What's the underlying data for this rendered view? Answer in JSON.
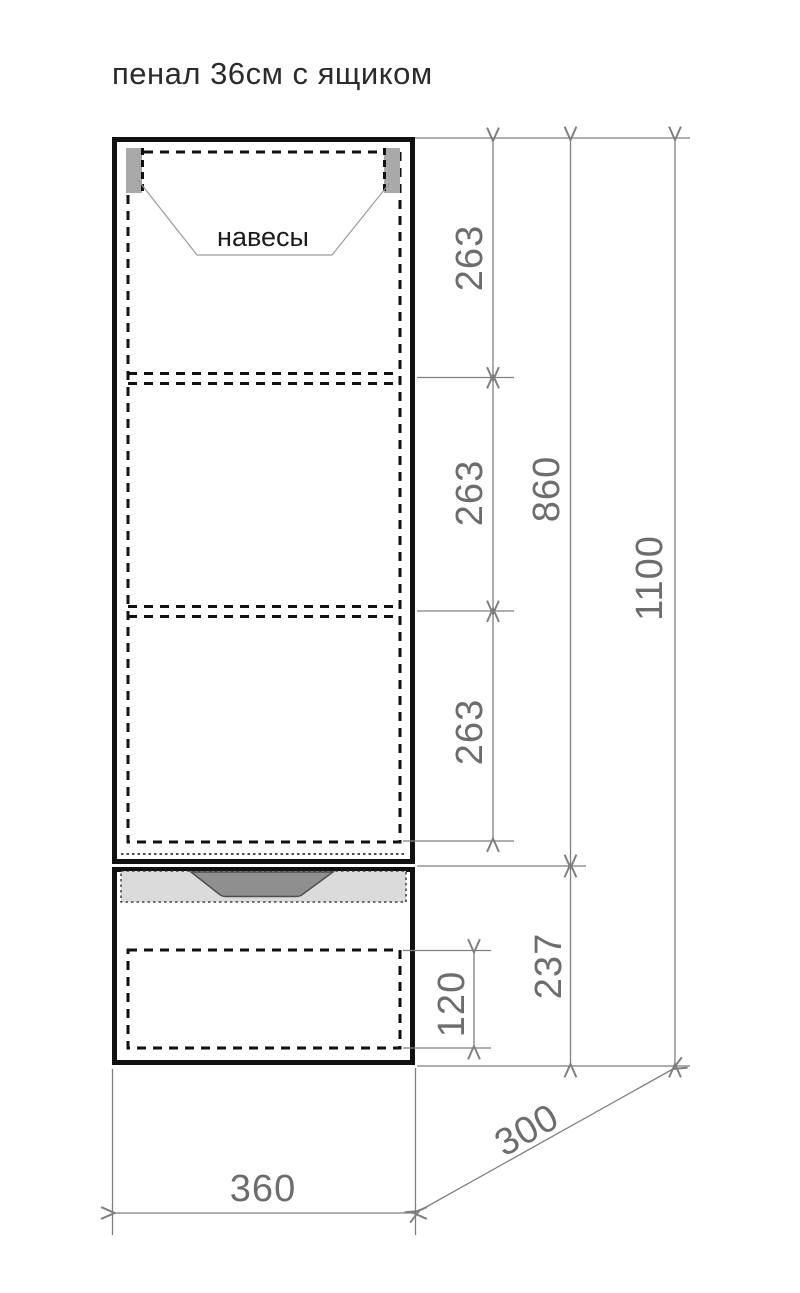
{
  "title": "пенал 36см с ящиком",
  "annotations": {
    "hangers_label": "навесы"
  },
  "dimensions": {
    "shelf_section_top": "263",
    "shelf_section_middle": "263",
    "shelf_section_bottom": "263",
    "cabinet_body_height": "860",
    "total_height": "1100",
    "drawer_unit_height": "237",
    "drawer_box_height": "120",
    "width": "360",
    "depth": "300"
  },
  "colors": {
    "outline": "#111111",
    "dashed_line": "#111111",
    "dimension_line": "#7f7f7f",
    "dimension_text": "#6d6d6d",
    "leader_line": "#9a9a9a",
    "hanger_fill": "#a9a9a9",
    "drawer_front_fill": "#dbdbdb",
    "handle_fill": "#8f8f8f",
    "handle_stroke": "#4f4f4f",
    "background": "#ffffff"
  }
}
